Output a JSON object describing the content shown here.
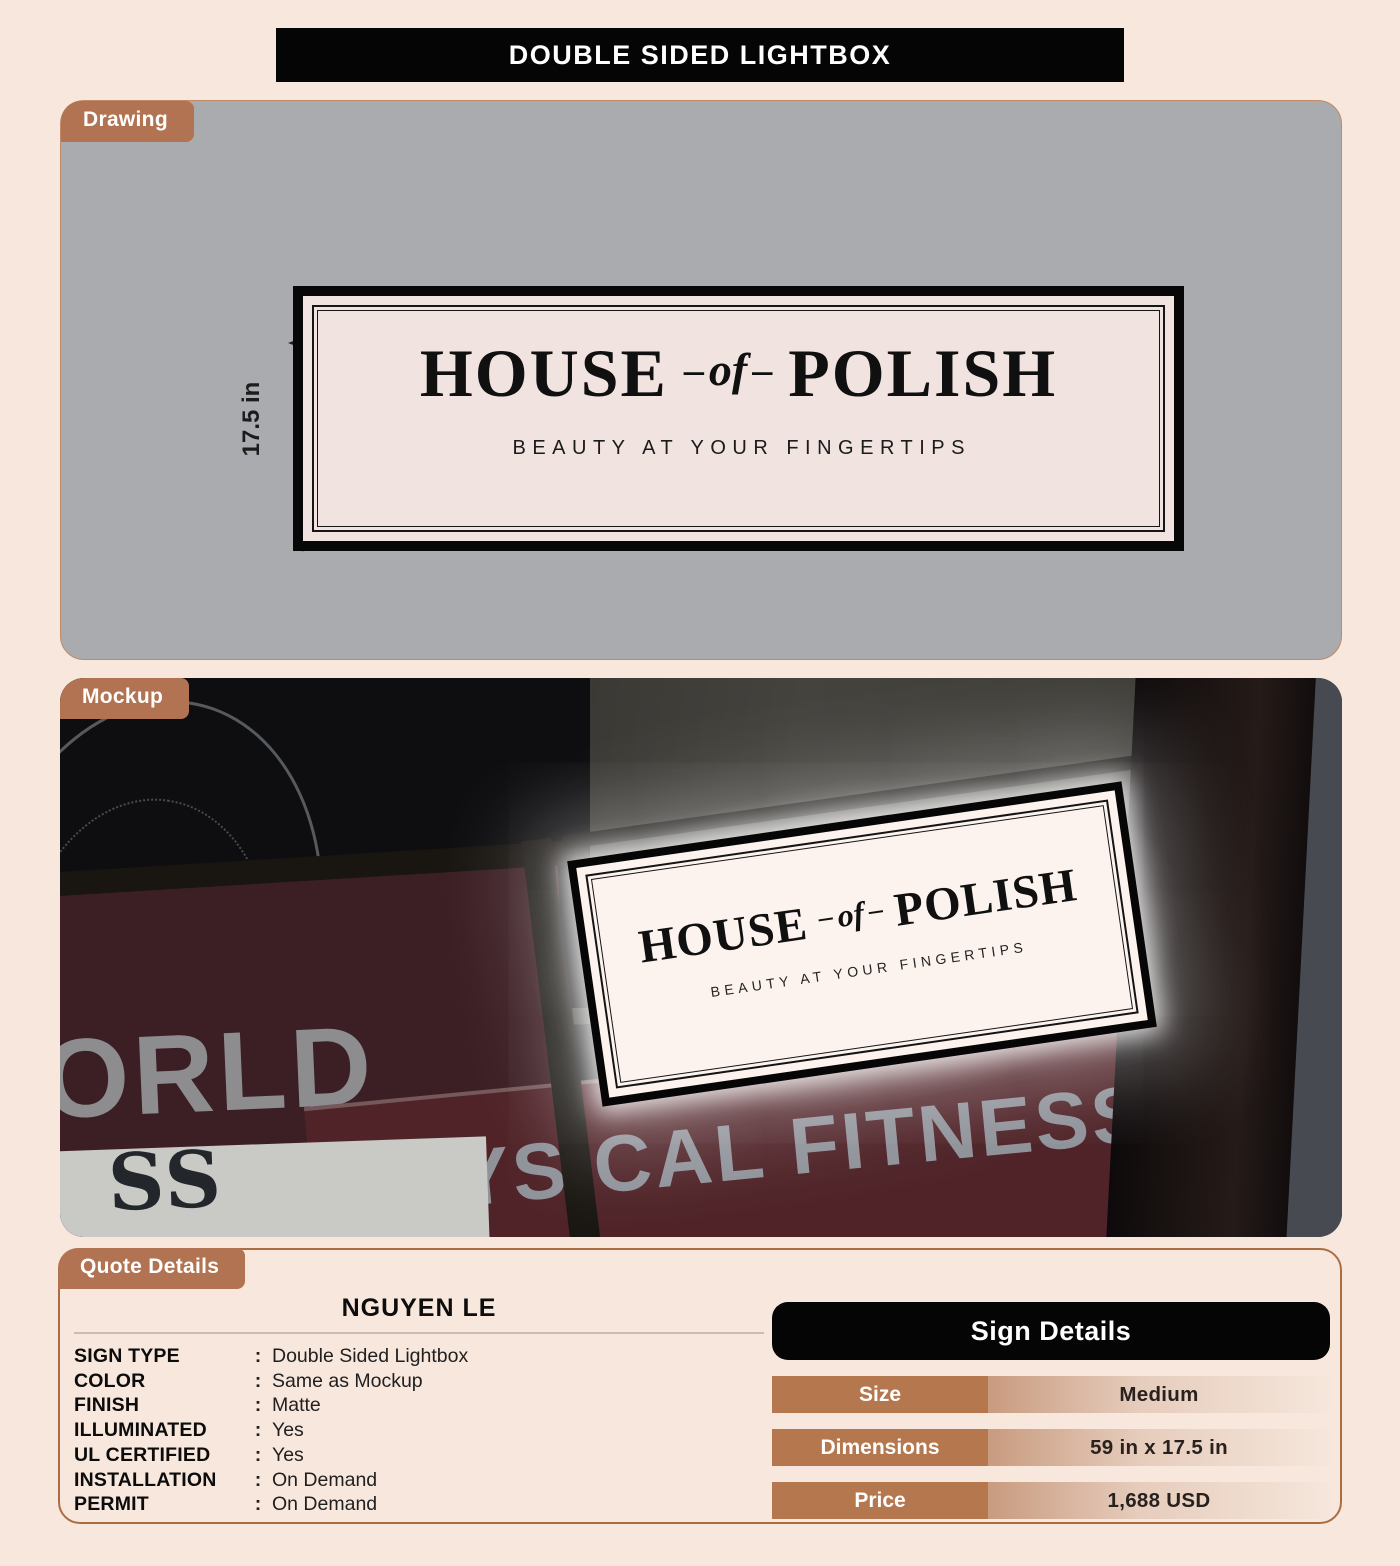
{
  "header": {
    "title": "DOUBLE SIDED LIGHTBOX"
  },
  "drawing": {
    "tab": "Drawing",
    "width_label": "59 in",
    "height_label": "17.5 in"
  },
  "sign": {
    "word1": "HOUSE",
    "dash": "–",
    "connector": "of",
    "word2": "POLISH",
    "tagline": "BEAUTY AT YOUR FINGERTIPS"
  },
  "mockup": {
    "tab": "Mockup",
    "photo_texts": {
      "neon": "AMING",
      "neon_sub": "IU",
      "left_sign": "ORLD",
      "bottom_sign": "PHYSICAL FITNESS",
      "corner_sign": "SS"
    }
  },
  "quote": {
    "tab": "Quote Details",
    "customer": "NGUYEN LE",
    "colon": ":",
    "rows": [
      {
        "label": "SIGN TYPE",
        "value": "Double Sided Lightbox"
      },
      {
        "label": "COLOR",
        "value": "Same as Mockup"
      },
      {
        "label": "FINISH",
        "value": "Matte"
      },
      {
        "label": "ILLUMINATED",
        "value": "Yes"
      },
      {
        "label": "UL CERTIFIED",
        "value": "Yes"
      },
      {
        "label": "INSTALLATION",
        "value": "On Demand"
      },
      {
        "label": "PERMIT",
        "value": "On Demand"
      }
    ]
  },
  "sign_details": {
    "title": "Sign Details",
    "rows": [
      {
        "label": "Size",
        "value": "Medium"
      },
      {
        "label": "Dimensions",
        "value": "59 in x 17.5 in"
      },
      {
        "label": "Price",
        "value": "1,688 USD"
      }
    ]
  },
  "colors": {
    "page_bg": "#f8e7dd",
    "copper": "#b17351",
    "panel_border": "#ad6d43",
    "drawing_bg": "#a9abae",
    "sign_cream": "#f0e3e0",
    "black": "#050505",
    "detail_gradient_start": "#c99b7f",
    "detail_gradient_end": "#f6e6db"
  }
}
